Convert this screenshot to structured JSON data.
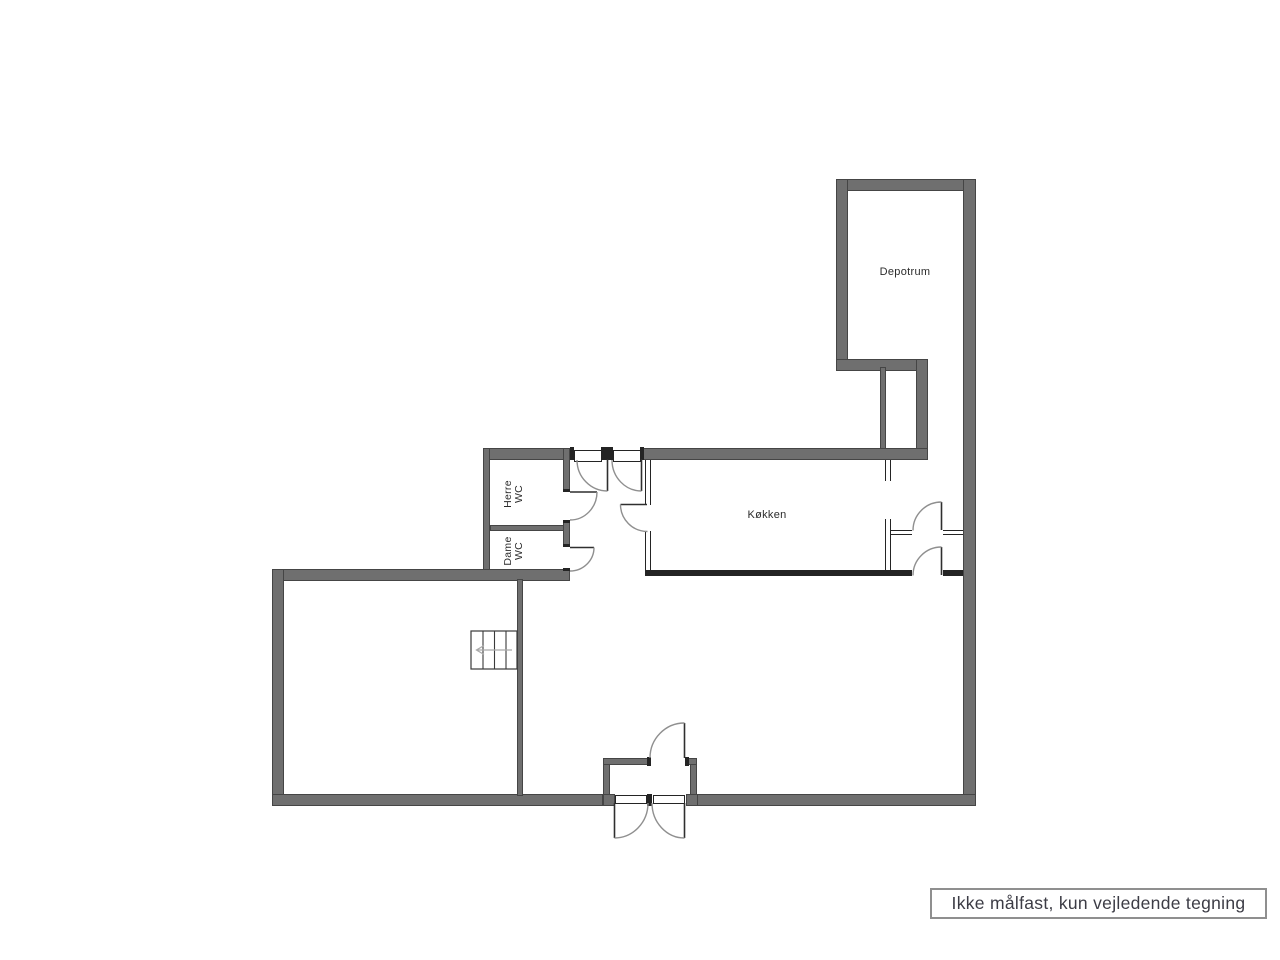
{
  "rooms": {
    "depotrum": {
      "label": "Depotrum"
    },
    "kitchen": {
      "label": "Køkken"
    },
    "herre_wc": {
      "line1": "Herre",
      "line2": "WC"
    },
    "dame_wc": {
      "line1": "Dame",
      "line2": "WC"
    }
  },
  "footer": {
    "disclaimer": "Ikke målfast, kun vejledende tegning"
  },
  "colors": {
    "wall": "#6f6f6f",
    "wall_edge": "#454545",
    "partition": "#242424",
    "door_arc": "#8f8f8f",
    "door_leaf": "#2f2f2f",
    "label_text": "#2b2b2b",
    "footer_text": "#3c3c45",
    "footer_border": "#8f8f8f"
  }
}
